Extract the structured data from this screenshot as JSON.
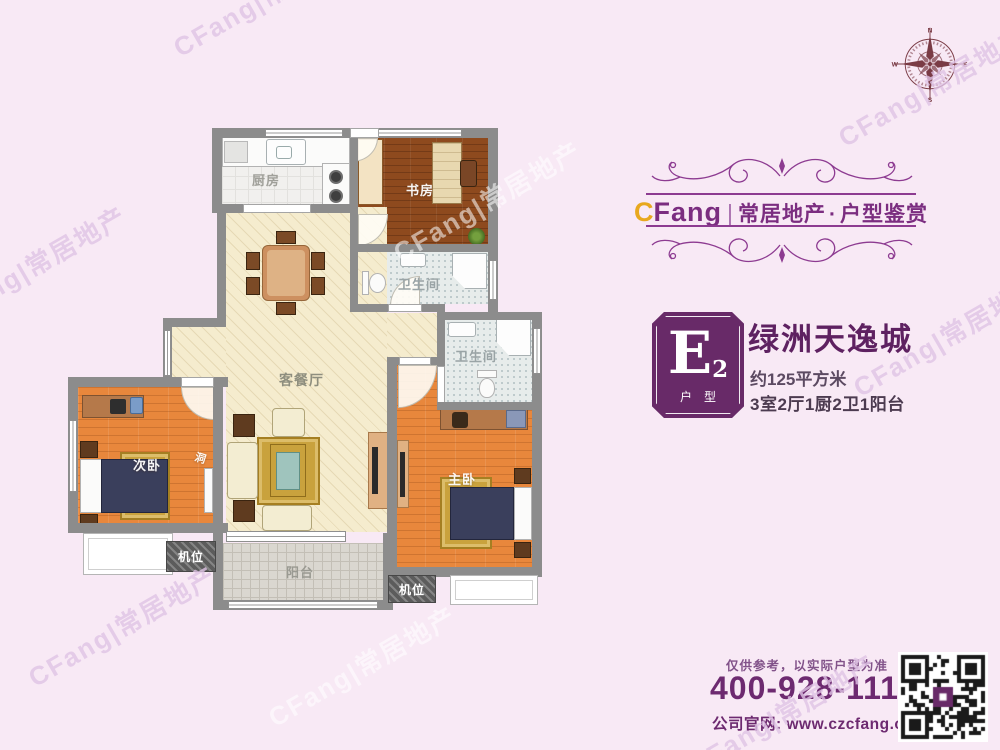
{
  "watermark": {
    "text": "CFang|常居地产"
  },
  "compass": {
    "n": "N",
    "e": "E",
    "s": "S",
    "w": "W"
  },
  "brand": {
    "logo_c": "C",
    "logo_fang": "Fang",
    "separator": "|",
    "company": "常居地产",
    "dot": "·",
    "series": "户型鉴赏"
  },
  "unit": {
    "code_letter": "E",
    "code_number": "2",
    "badge_caption": "户型",
    "name": "绿洲天逸城",
    "area": "约125平方米",
    "rooms_spec": "3室2厅1厨2卫1阳台"
  },
  "footer": {
    "disclaimer": "仅供参考，以实际户型为准",
    "phone": "400-928-1117",
    "website": "公司官网: www.czcfang.com"
  },
  "floorplan": {
    "kitchen": "厨房",
    "study": "书房",
    "bath_upper": "卫生间",
    "bath_lower": "卫生间",
    "living_dining": "客餐厅",
    "second_bedroom": "次卧",
    "master_bedroom": "主卧",
    "balcony": "阳台",
    "ac_left": "机位",
    "ac_right": "机位",
    "opening": "洞"
  },
  "colors": {
    "background_pink": "#f8e9f5",
    "brand_purple": "#7b2d80",
    "badge_purple": "#682a68",
    "accent_gold": "#e8a81e",
    "title_purple": "#5e2161",
    "wall_gray": "#8c8c8c",
    "compass_maroon": "#7a3b45"
  }
}
